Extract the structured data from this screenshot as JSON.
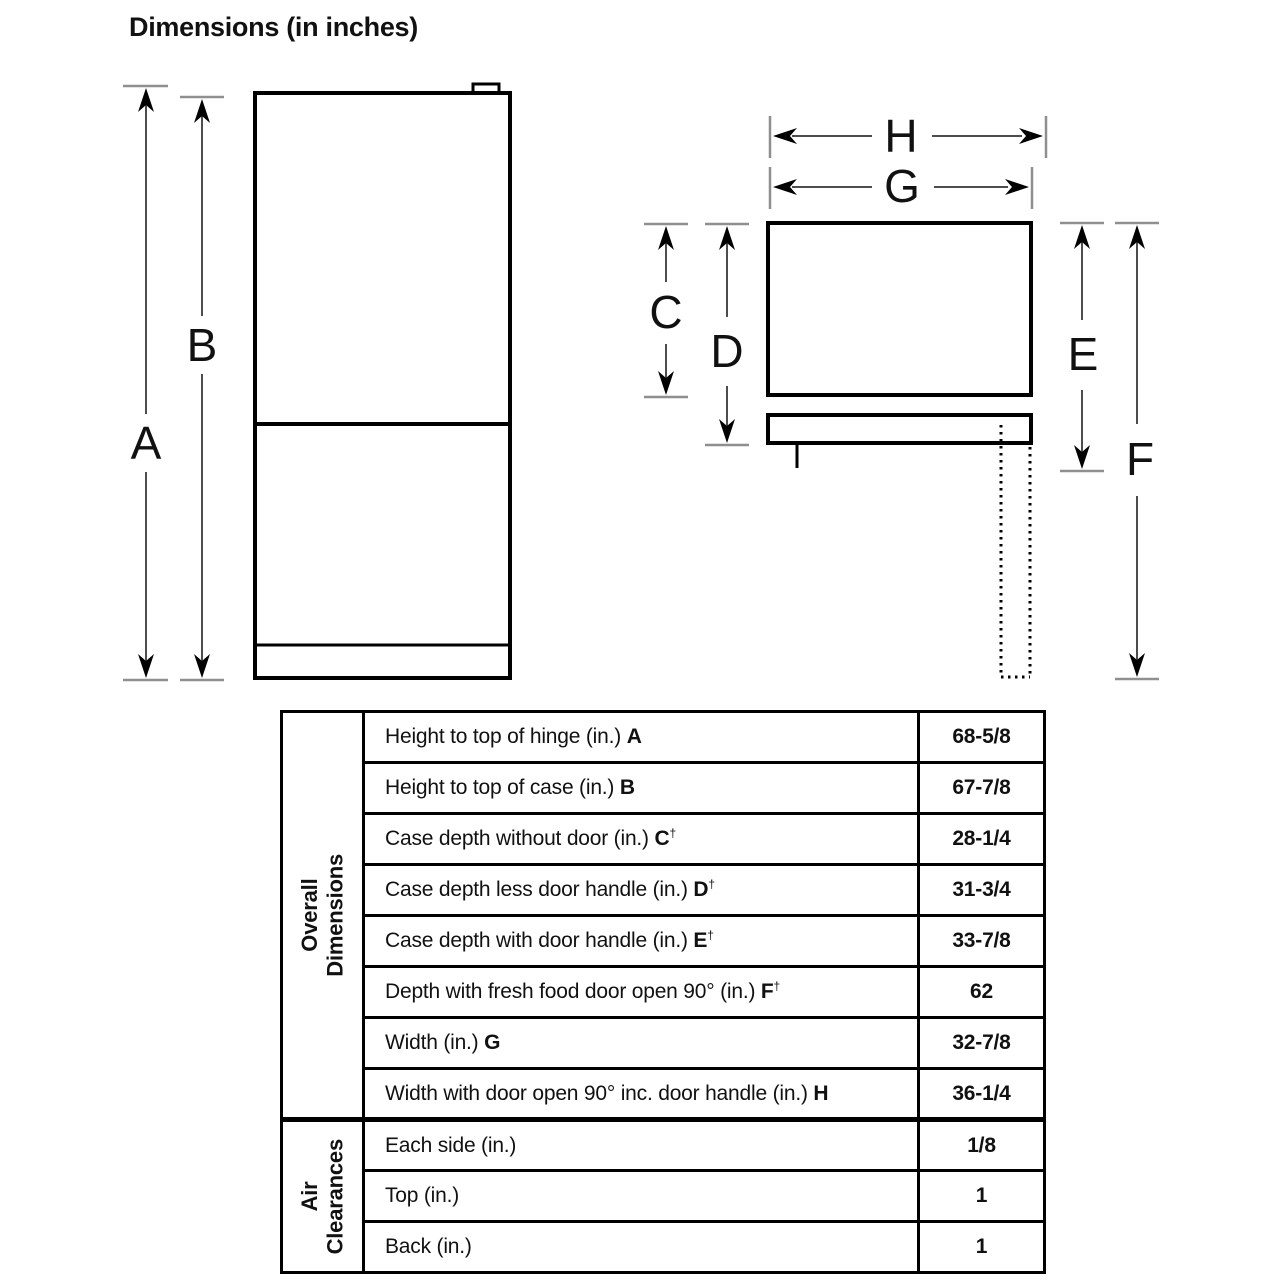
{
  "title": "Dimensions (in inches)",
  "diagram": {
    "labels": {
      "a": "A",
      "b": "B",
      "c": "C",
      "d": "D",
      "e": "E",
      "f": "F",
      "g": "G",
      "h": "H"
    }
  },
  "table": {
    "sections": [
      {
        "header_line1": "Overall",
        "header_line2": "Dimensions",
        "rows": [
          {
            "label": "Height to top of hinge (in.)",
            "letter": "A",
            "dagger": "",
            "value": "68-5/8"
          },
          {
            "label": "Height to top of case (in.)",
            "letter": "B",
            "dagger": "",
            "value": "67-7/8"
          },
          {
            "label": "Case depth without door (in.)",
            "letter": "C",
            "dagger": "†",
            "value": "28-1/4"
          },
          {
            "label": "Case depth less door handle (in.)",
            "letter": "D",
            "dagger": "†",
            "value": "31-3/4"
          },
          {
            "label": "Case depth with door handle (in.)",
            "letter": "E",
            "dagger": "†",
            "value": "33-7/8"
          },
          {
            "label": "Depth with fresh food door open 90° (in.)",
            "letter": "F",
            "dagger": "†",
            "value": "62"
          },
          {
            "label": "Width (in.)",
            "letter": "G",
            "dagger": "",
            "value": "32-7/8"
          },
          {
            "label": "Width with door open 90° inc. door handle (in.)",
            "letter": "H",
            "dagger": "",
            "value": "36-1/4"
          }
        ]
      },
      {
        "header_line1": "Air",
        "header_line2": "Clearances",
        "rows": [
          {
            "label": "Each side (in.)",
            "letter": "",
            "dagger": "",
            "value": "1/8"
          },
          {
            "label": "Top (in.)",
            "letter": "",
            "dagger": "",
            "value": "1"
          },
          {
            "label": "Back (in.)",
            "letter": "",
            "dagger": "",
            "value": "1"
          }
        ]
      }
    ]
  }
}
